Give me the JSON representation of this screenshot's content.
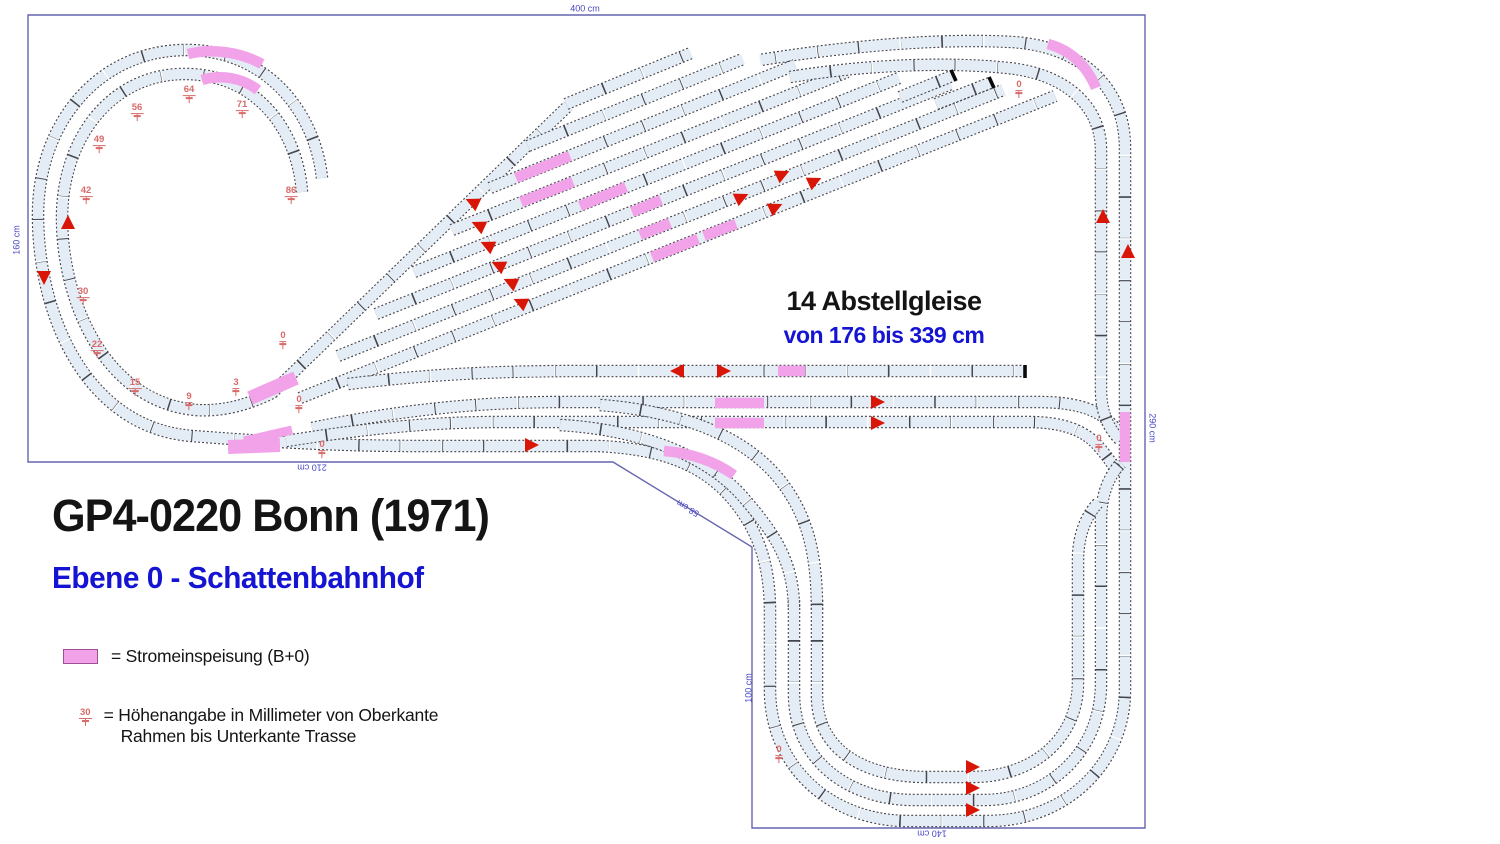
{
  "title": "GP4-0220 Bonn (1971)",
  "subtitle": "Ebene 0 - Schattenbahnhof",
  "annotation": {
    "line1": "14 Abstellgleise",
    "line2": "von 176 bis 339 cm"
  },
  "legend": {
    "power_label": "= Stromeinspeisung (B+0)",
    "height_value": "30",
    "height_label_line1": "= Höhenangabe in Millimeter von Oberkante",
    "height_label_line2": "Rahmen bis Unterkante Trasse"
  },
  "colors": {
    "track_fill": "#e4edf5",
    "track_edge": "#45454e",
    "power_pink": "#f2a2e8",
    "signal_red": "#d91507",
    "marker_red": "#d96a6a",
    "dimension_blue": "#4848c4",
    "accent_blue": "#1414d2",
    "boundary_blue": "#6565b0"
  },
  "plan": {
    "dimension_labels": [
      {
        "text": "400 cm",
        "x": 585,
        "y": 9,
        "rot": 0
      },
      {
        "text": "160 cm",
        "x": 17,
        "y": 240,
        "rot": -90
      },
      {
        "text": "210 cm",
        "x": 312,
        "y": 467,
        "rot": 180
      },
      {
        "text": "58 cm",
        "x": 688,
        "y": 508,
        "rot": 211
      },
      {
        "text": "100 cm",
        "x": 749,
        "y": 688,
        "rot": -90
      },
      {
        "text": "140 cm",
        "x": 932,
        "y": 833,
        "rot": 180
      },
      {
        "text": "290 cm",
        "x": 1152,
        "y": 428,
        "rot": 90
      }
    ],
    "height_markers": [
      {
        "value": "64",
        "x": 189,
        "y": 95
      },
      {
        "value": "56",
        "x": 137,
        "y": 113
      },
      {
        "value": "49",
        "x": 99,
        "y": 145
      },
      {
        "value": "42",
        "x": 86,
        "y": 196
      },
      {
        "value": "71",
        "x": 242,
        "y": 110
      },
      {
        "value": "86",
        "x": 291,
        "y": 196
      },
      {
        "value": "30",
        "x": 83,
        "y": 297
      },
      {
        "value": "22",
        "x": 97,
        "y": 350
      },
      {
        "value": "15",
        "x": 135,
        "y": 388
      },
      {
        "value": "9",
        "x": 189,
        "y": 402
      },
      {
        "value": "3",
        "x": 236,
        "y": 388
      },
      {
        "value": "0",
        "x": 283,
        "y": 341
      },
      {
        "value": "0",
        "x": 299,
        "y": 405
      },
      {
        "value": "0",
        "x": 322,
        "y": 450
      },
      {
        "value": "0",
        "x": 1019,
        "y": 90
      },
      {
        "value": "0",
        "x": 1099,
        "y": 444
      },
      {
        "value": "0",
        "x": 779,
        "y": 755
      }
    ],
    "direction_arrows": [
      {
        "x": 68,
        "y": 222,
        "rot": 0
      },
      {
        "x": 44,
        "y": 278,
        "rot": 180
      },
      {
        "x": 472,
        "y": 202,
        "rot": -65
      },
      {
        "x": 478,
        "y": 225,
        "rot": -65
      },
      {
        "x": 487,
        "y": 245,
        "rot": -65
      },
      {
        "x": 498,
        "y": 265,
        "rot": -65
      },
      {
        "x": 510,
        "y": 282,
        "rot": -65
      },
      {
        "x": 520,
        "y": 302,
        "rot": -65
      },
      {
        "x": 742,
        "y": 197,
        "rot": 65
      },
      {
        "x": 776,
        "y": 207,
        "rot": 65
      },
      {
        "x": 783,
        "y": 174,
        "rot": 65
      },
      {
        "x": 815,
        "y": 181,
        "rot": 65
      },
      {
        "x": 677,
        "y": 371,
        "rot": -90
      },
      {
        "x": 724,
        "y": 371,
        "rot": 90
      },
      {
        "x": 878,
        "y": 402,
        "rot": 90
      },
      {
        "x": 878,
        "y": 423,
        "rot": 90
      },
      {
        "x": 532,
        "y": 445,
        "rot": 90
      },
      {
        "x": 1103,
        "y": 216,
        "rot": 0
      },
      {
        "x": 1128,
        "y": 251,
        "rot": 0
      },
      {
        "x": 973,
        "y": 767,
        "rot": 90
      },
      {
        "x": 973,
        "y": 788,
        "rot": 90
      },
      {
        "x": 973,
        "y": 810,
        "rot": 90
      }
    ]
  }
}
